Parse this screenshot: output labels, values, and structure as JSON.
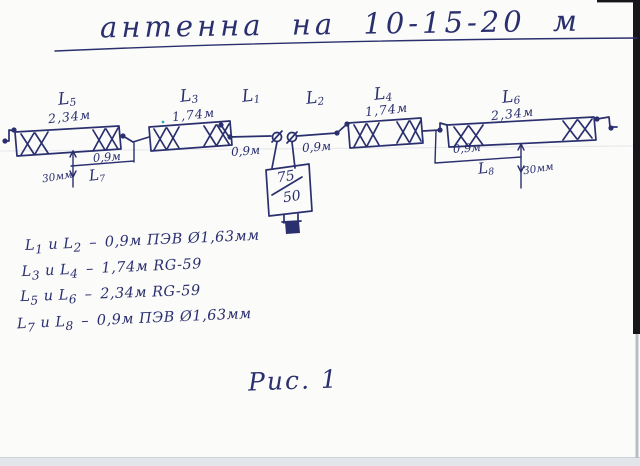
{
  "title": "антенна на 10-15-20 м",
  "figure_caption": "Рис. 1",
  "colors": {
    "ink": "#2a2f6e",
    "paper": "#fbfbfa",
    "scan_border": "#15151a"
  },
  "elements": {
    "l5": {
      "base": "L",
      "sub": "5",
      "length": "2,34м"
    },
    "l3": {
      "base": "L",
      "sub": "3",
      "length": "1,74м"
    },
    "l1": {
      "base": "L",
      "sub": "1"
    },
    "l2": {
      "base": "L",
      "sub": "2"
    },
    "l4": {
      "base": "L",
      "sub": "4",
      "length": "1,74м"
    },
    "l6": {
      "base": "L",
      "sub": "6",
      "length": "2,34м"
    }
  },
  "dimensions": {
    "left_wire": "0,9м",
    "right_wire": "0,9м",
    "l7": {
      "base": "L",
      "sub": "7",
      "length": "0,9м",
      "gap": "30мм"
    },
    "l8": {
      "base": "L",
      "sub": "8",
      "length": "0,9м",
      "gap": "30мм"
    }
  },
  "balun": {
    "top": "75",
    "bottom": "50"
  },
  "legend": {
    "letter": "L",
    "joiner": "и",
    "dash": "–",
    "items": [
      {
        "pair": [
          "1",
          "2"
        ],
        "value": "0,9м ПЭВ Ø1,63мм"
      },
      {
        "pair": [
          "3",
          "4"
        ],
        "value": "1,74м RG-59"
      },
      {
        "pair": [
          "5",
          "6"
        ],
        "value": "2,34м RG-59"
      },
      {
        "pair": [
          "7",
          "8"
        ],
        "value": "0,9м ПЭВ Ø1,63мм"
      }
    ]
  }
}
